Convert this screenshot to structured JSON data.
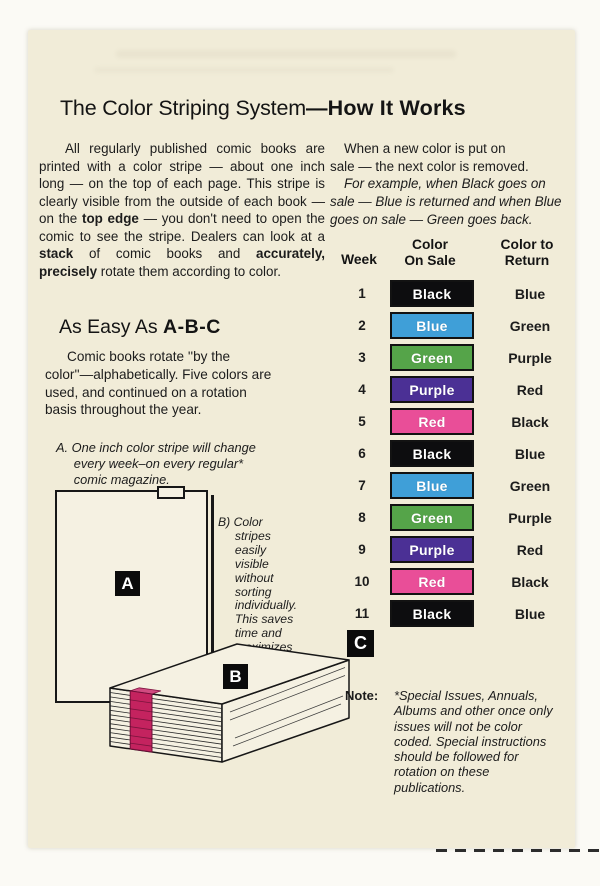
{
  "title": {
    "main": "The Color Striping  System",
    "emph": "—How It Works"
  },
  "intro_left": [
    {
      "t": "All regularly published comic books are printed with a color stripe — about one inch long — on the top of each page. This stripe is clearly visible from the outside of each book — on the "
    },
    {
      "t": "top edge",
      "b": true
    },
    {
      "t": " — you don't need to open the comic to see the stripe. Dealers can look at a "
    },
    {
      "t": "stack",
      "b": true
    },
    {
      "t": " of comic books and "
    },
    {
      "t": "accurately, precisely",
      "b": true
    },
    {
      "t": " rotate them according to color."
    }
  ],
  "intro_right": {
    "p1": "When a new color is put on\nsale — the next color is removed.",
    "p2": "For example, when Black goes on\nsale — Blue is returned and when Blue\ngoes on sale — Green goes back."
  },
  "easy_heading": {
    "main": "As Easy As ",
    "emph": "A-B-C"
  },
  "easy_body": "Comic books rotate ''by the\ncolor''—alphabetically. Five colors are\nused, and continued on a rotation\nbasis throughout the year.",
  "item_a": "A. One inch color stripe will change\n     every week–on every regular*\n     comic magazine.",
  "item_b": "B) Color\n     stripes\n     easily\n     visible\n     without\n     sorting\n     individually.\n     This saves\n     time and\n     maximizes\n     accuracy.",
  "badges": {
    "a": "A",
    "b": "B",
    "c": "C"
  },
  "table": {
    "headers": {
      "week": "Week",
      "on_sale": "Color\nOn Sale",
      "return": "Color to\nReturn"
    },
    "rows": [
      {
        "week": "1",
        "on_sale": "Black",
        "return": "Blue",
        "color": "#0d0d0f"
      },
      {
        "week": "2",
        "on_sale": "Blue",
        "return": "Green",
        "color": "#3f9fd8"
      },
      {
        "week": "3",
        "on_sale": "Green",
        "return": "Purple",
        "color": "#55a449"
      },
      {
        "week": "4",
        "on_sale": "Purple",
        "return": "Red",
        "color": "#4b3095"
      },
      {
        "week": "5",
        "on_sale": "Red",
        "return": "Black",
        "color": "#e94e98"
      },
      {
        "week": "6",
        "on_sale": "Black",
        "return": "Blue",
        "color": "#0d0d0f"
      },
      {
        "week": "7",
        "on_sale": "Blue",
        "return": "Green",
        "color": "#3f9fd8"
      },
      {
        "week": "8",
        "on_sale": "Green",
        "return": "Purple",
        "color": "#55a449"
      },
      {
        "week": "9",
        "on_sale": "Purple",
        "return": "Red",
        "color": "#4b3095"
      },
      {
        "week": "10",
        "on_sale": "Red",
        "return": "Black",
        "color": "#e94e98"
      },
      {
        "week": "11",
        "on_sale": "Black",
        "return": "Blue",
        "color": "#0d0d0f"
      }
    ]
  },
  "note": {
    "label": "Note:",
    "body": "*Special Issues, Annuals,\nAlbums and other once only\nissues will not be color\ncoded. Special instructions\nshould be followed for\nrotation on these\npublications."
  },
  "colors": {
    "page": "#f1ecd8",
    "stripe": "#c4235f",
    "stripe_tab": "#d14b80"
  }
}
